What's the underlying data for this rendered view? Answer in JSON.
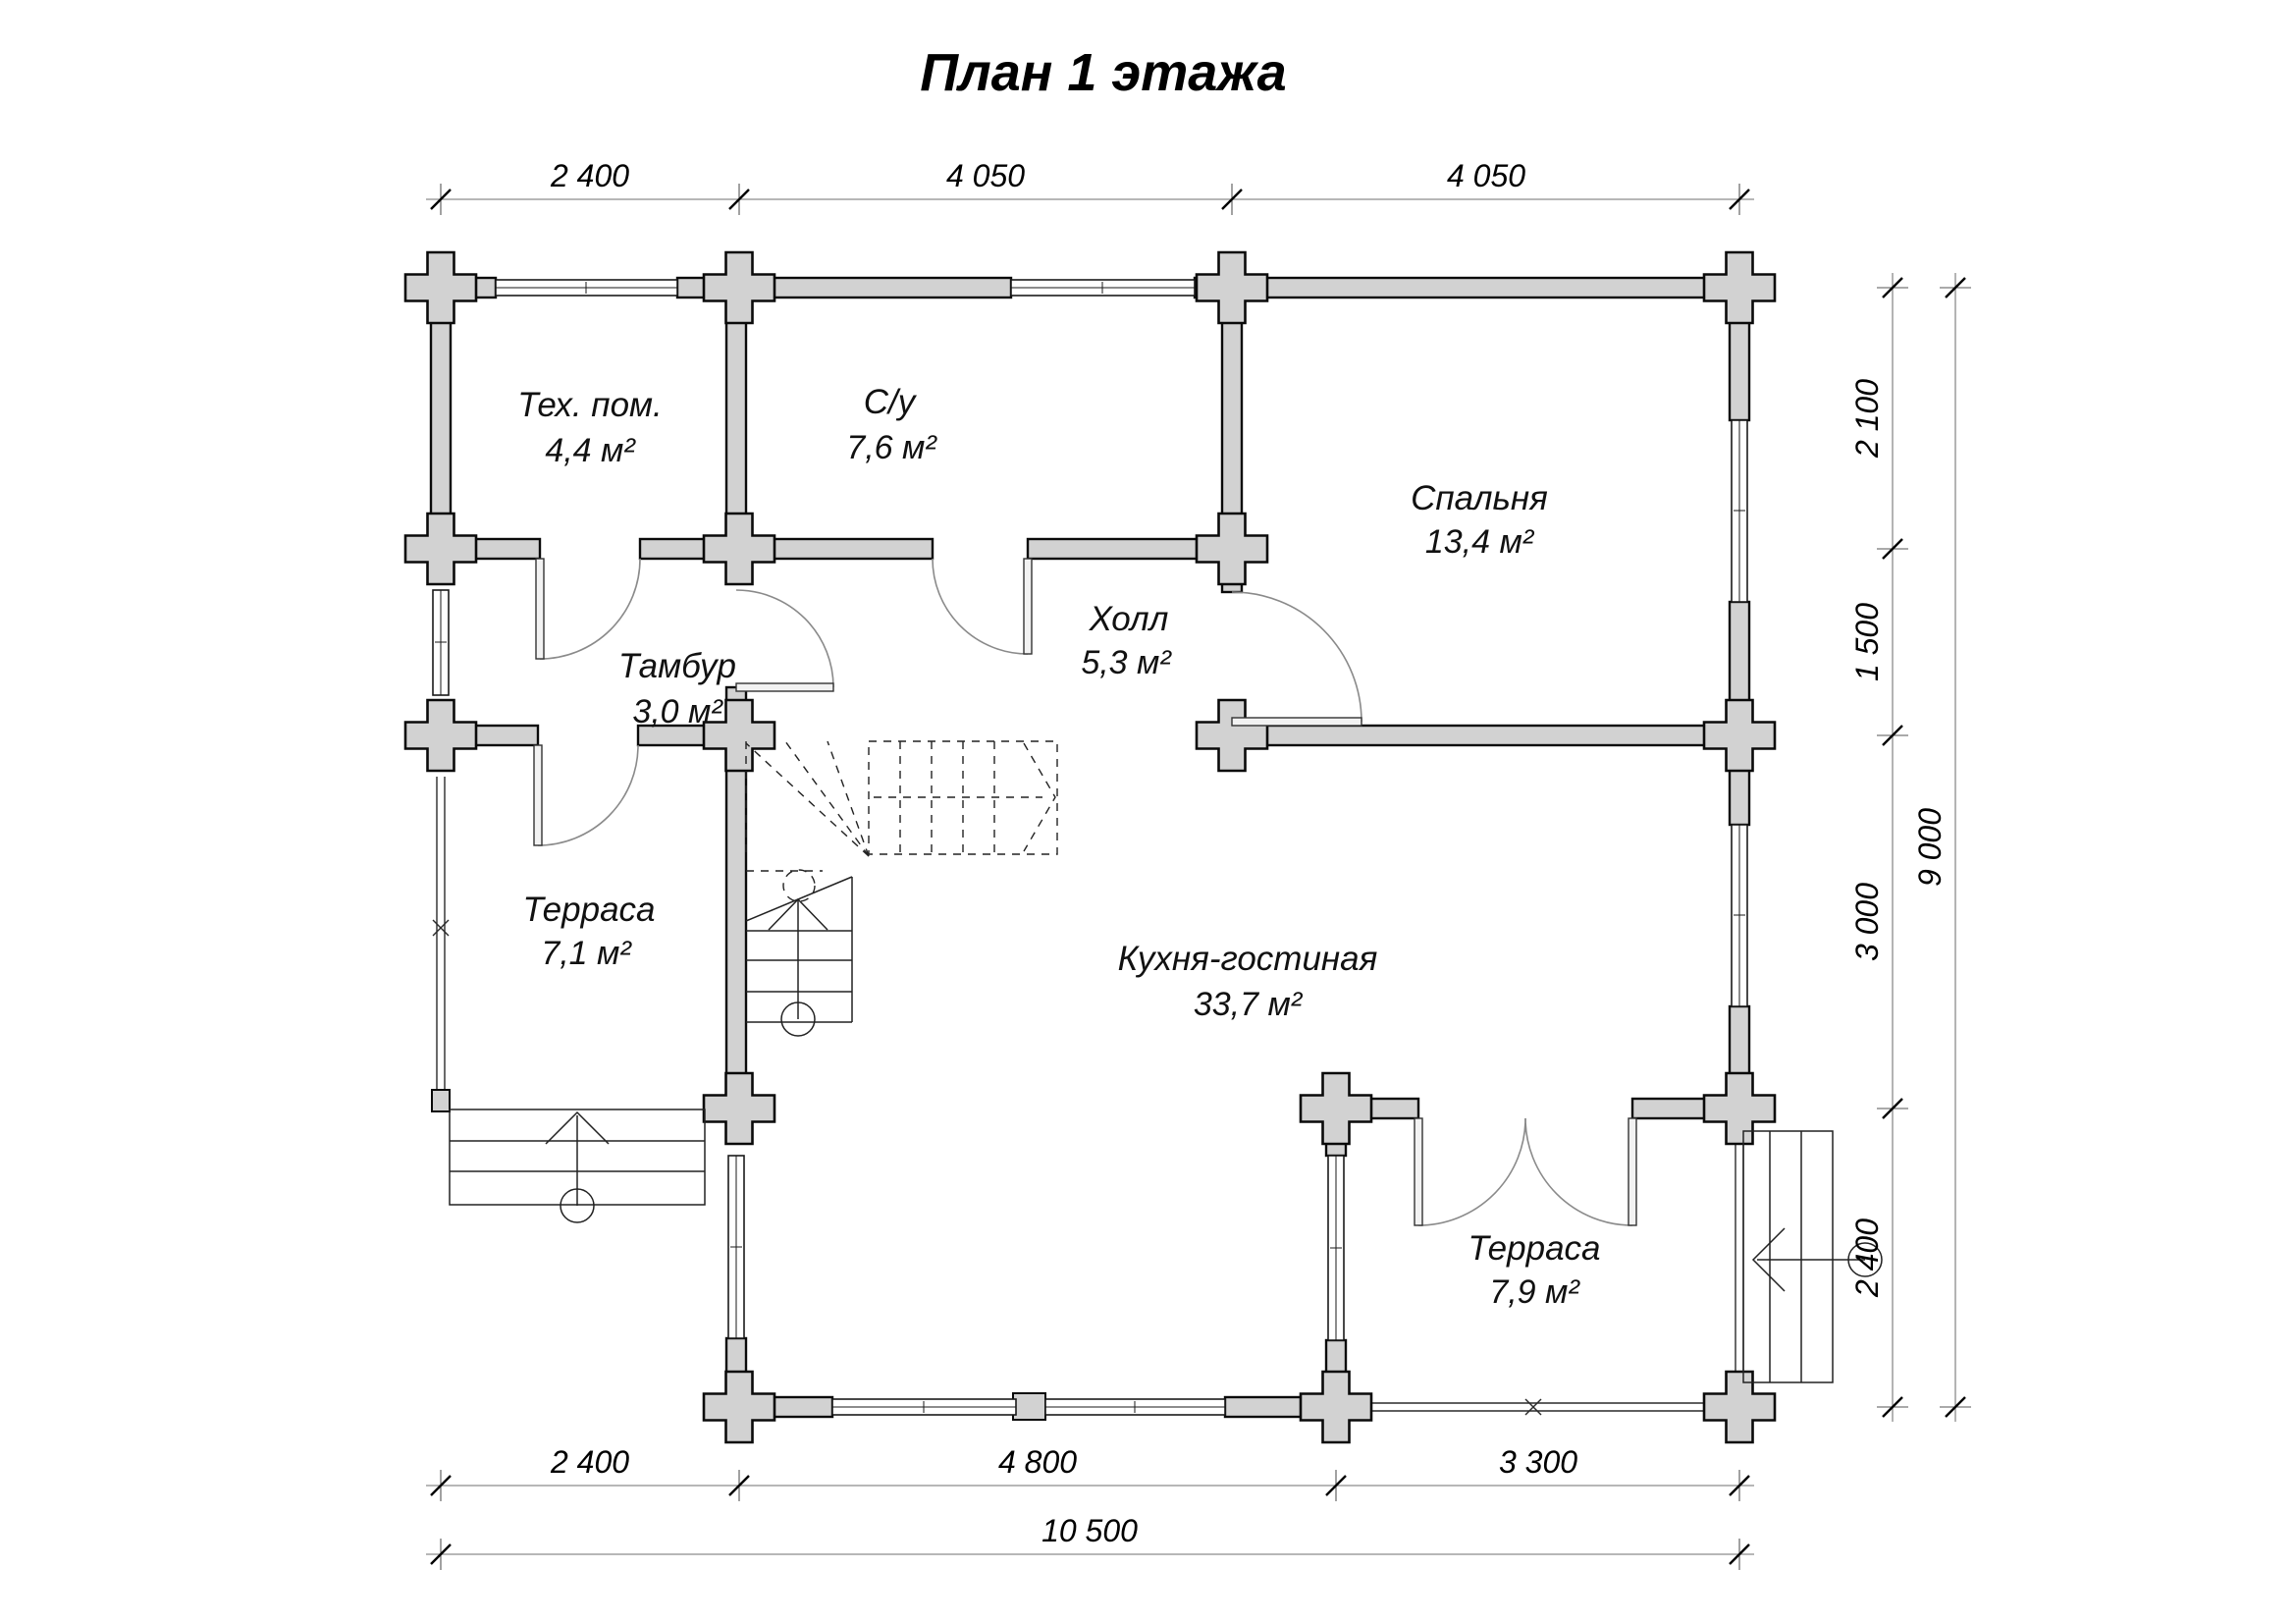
{
  "title": "План 1 этажа",
  "rooms": [
    {
      "id": "tech",
      "name": "Тех. пом.",
      "area": "4,4 м²"
    },
    {
      "id": "su",
      "name": "С/у",
      "area": "7,6 м²"
    },
    {
      "id": "bedroom",
      "name": "Спальня",
      "area": "13,4 м²"
    },
    {
      "id": "tambour",
      "name": "Тамбур",
      "area": "3,0 м²"
    },
    {
      "id": "hall",
      "name": "Холл",
      "area": "5,3 м²"
    },
    {
      "id": "terrace1",
      "name": "Терраса",
      "area": "7,1 м²"
    },
    {
      "id": "kitchen",
      "name": "Кухня-гостиная",
      "area": "33,7 м²"
    },
    {
      "id": "terrace2",
      "name": "Терраса",
      "area": "7,9 м²"
    }
  ],
  "dimensions": {
    "top": [
      "2 400",
      "4 050",
      "4 050"
    ],
    "bottom_inner": [
      "2 400",
      "4 800",
      "3 300"
    ],
    "bottom_total": "10 500",
    "right_inner": [
      "2 100",
      "1 500",
      "3 000",
      "2 400"
    ],
    "right_total": "9 000"
  },
  "colors": {
    "wall_fill": "#d2d2d2",
    "outline": "#0a0a0a",
    "dim_line": "#8c8c8c"
  }
}
